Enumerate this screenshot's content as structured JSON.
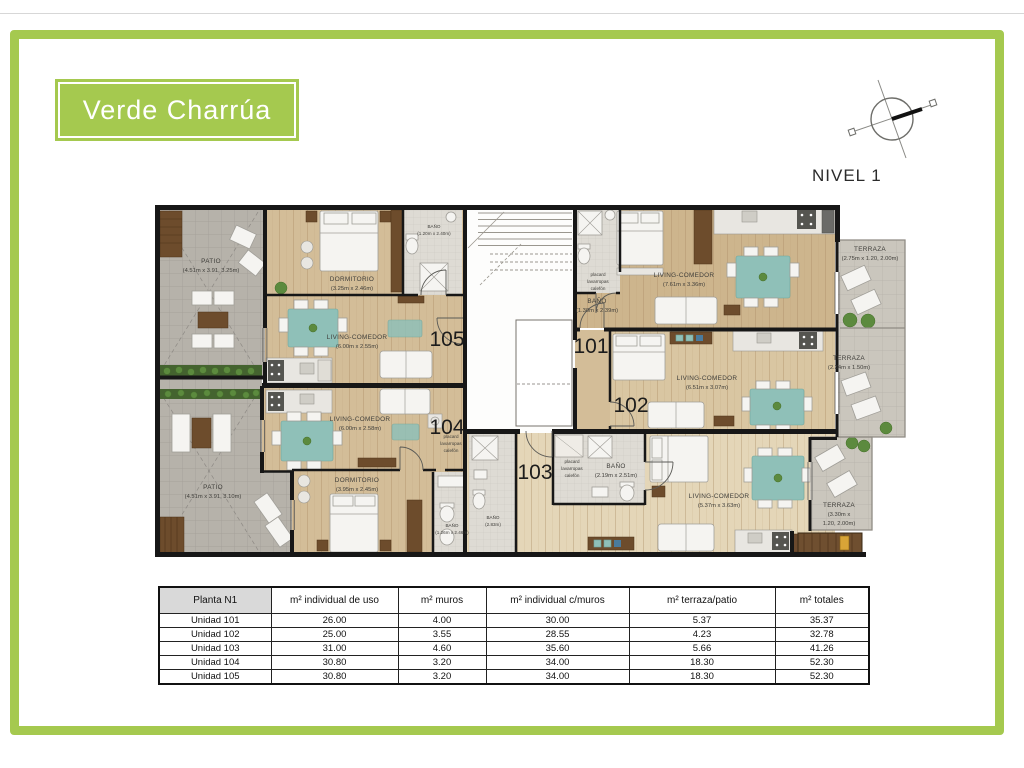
{
  "branding": {
    "logo_text": "Verde Charrúa"
  },
  "level_label": "NIVEL 1",
  "colors": {
    "brand_green": "#a5c94f",
    "wall": "#171717",
    "wood": "#d3bd98",
    "wood_light": "#e4d6b8",
    "tile_patio": "#b6b2aa",
    "tile_terrace": "#cac6bd",
    "tile_bath": "#dedbd4",
    "accent_teal": "#8fc0b8",
    "hedge_green": "#44632f"
  },
  "plan": {
    "unit_numbers": {
      "u101": "101",
      "u102": "102",
      "u103": "103",
      "u104": "104",
      "u105": "105"
    },
    "rooms": {
      "patio105": {
        "name": "PATIO",
        "dims": "(4.51m x 3.91, 3.25m)"
      },
      "dormitorio105": {
        "name": "DORMITORIO",
        "dims": "(3.25m x 2.46m)"
      },
      "bano105": {
        "name": "BAÑO",
        "dims": "(1.20m x 2.40m)"
      },
      "living105": {
        "name": "LIVING-COMEDOR",
        "dims": "(6.00m x 2.55m)"
      },
      "patio104": {
        "name": "PATIO",
        "dims": "(4.51m x 3.91, 3.10m)"
      },
      "living104": {
        "name": "LIVING-COMEDOR",
        "dims": "(6.00m x 2.58m)"
      },
      "dormitorio104": {
        "name": "DORMITORIO",
        "dims": "(3.95m x 2.45m)"
      },
      "bano104": {
        "name": "BAÑO",
        "dims": "(1.26m x 2.46m)"
      },
      "bano101": {
        "name": "BAÑO",
        "dims": "(1.30m x 2.39m)"
      },
      "living101": {
        "name": "LIVING-COMEDOR",
        "dims": "(7.61m x 3.36m)"
      },
      "terraza101": {
        "name": "TERRAZA",
        "dims": "(2.75m x 1.20, 2.00m)"
      },
      "living102": {
        "name": "LIVING-COMEDOR",
        "dims": "(6.51m x 3.07m)"
      },
      "terraza102": {
        "name": "TERRAZA",
        "dims": "(2.34m x 1.50m)"
      },
      "bano103": {
        "name": "BAÑO",
        "dims": "(2.19m x 2.51m)"
      },
      "bano103b": {
        "name": "BAÑO",
        "dims": "(2.83m)"
      },
      "living103": {
        "name": "LIVING-COMEDOR",
        "dims": "(5.37m x 3.63m)"
      },
      "terraza103": {
        "name": "TERRAZA",
        "dims_line1": "(3.30m x",
        "dims_line2": "1.20, 2.00m)"
      },
      "placard": {
        "line1": "placard",
        "line2": "lavarropas",
        "line3": "calefón"
      }
    }
  },
  "table": {
    "headers": [
      "Planta N1",
      "m² individual de uso",
      "m² muros",
      "m² individual c/muros",
      "m² terraza/patio",
      "m² totales"
    ],
    "rows": [
      [
        "Unidad 101",
        "26.00",
        "4.00",
        "30.00",
        "5.37",
        "35.37"
      ],
      [
        "Unidad 102",
        "25.00",
        "3.55",
        "28.55",
        "4.23",
        "32.78"
      ],
      [
        "Unidad 103",
        "31.00",
        "4.60",
        "35.60",
        "5.66",
        "41.26"
      ],
      [
        "Unidad 104",
        "30.80",
        "3.20",
        "34.00",
        "18.30",
        "52.30"
      ],
      [
        "Unidad 105",
        "30.80",
        "3.20",
        "34.00",
        "18.30",
        "52.30"
      ]
    ]
  }
}
